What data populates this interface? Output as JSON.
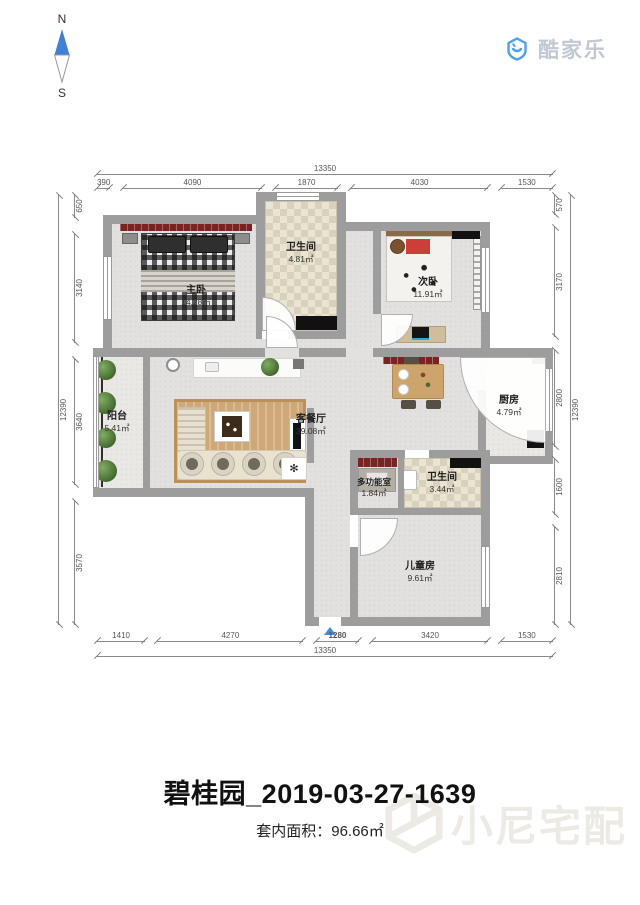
{
  "compass": {
    "north": "N",
    "south": "S"
  },
  "logo": {
    "brand": "酷家乐"
  },
  "plan": {
    "rooms": [
      {
        "id": "master",
        "name": "主卧",
        "area": "14.28㎡"
      },
      {
        "id": "bath-top",
        "name": "卫生间",
        "area": "4.81㎡"
      },
      {
        "id": "bedroom2",
        "name": "次卧",
        "area": "11.91㎡"
      },
      {
        "id": "balcony",
        "name": "阳台",
        "area": "5.41㎡"
      },
      {
        "id": "living",
        "name": "客餐厅",
        "area": "39.08㎡"
      },
      {
        "id": "kitchen",
        "name": "厨房",
        "area": "4.79㎡"
      },
      {
        "id": "multi",
        "name": "多功能室",
        "area": "1.84㎡"
      },
      {
        "id": "bath2",
        "name": "卫生间",
        "area": "3.44㎡"
      },
      {
        "id": "kids",
        "name": "儿童房",
        "area": "9.61㎡"
      }
    ],
    "dimensions": {
      "top": {
        "total": "13350",
        "segments": [
          "390",
          "4090",
          "1870",
          "4030",
          "1530"
        ]
      },
      "bottom": {
        "total": "13350",
        "segments": [
          "1410",
          "4270",
          "1280",
          "3420",
          "1530"
        ],
        "highlight": "1280"
      },
      "left": {
        "total": "12390",
        "segments": [
          "650",
          "3140",
          "3640",
          "3570"
        ]
      },
      "right": {
        "total": "12390",
        "segments": [
          "570",
          "3170",
          "2800",
          "1600",
          "2810"
        ]
      }
    }
  },
  "footer": {
    "title": "碧桂园_2019-03-27-1639",
    "area_label": "套内面积：",
    "area_value": "96.66㎡"
  },
  "watermark": {
    "brand": "小尼宅配"
  },
  "colors": {
    "accent_blue": "#3f8cda",
    "wall_gray": "#9d9d9d",
    "headboard_red": "#7b2222",
    "logo_blue": "#4aa0f5"
  }
}
